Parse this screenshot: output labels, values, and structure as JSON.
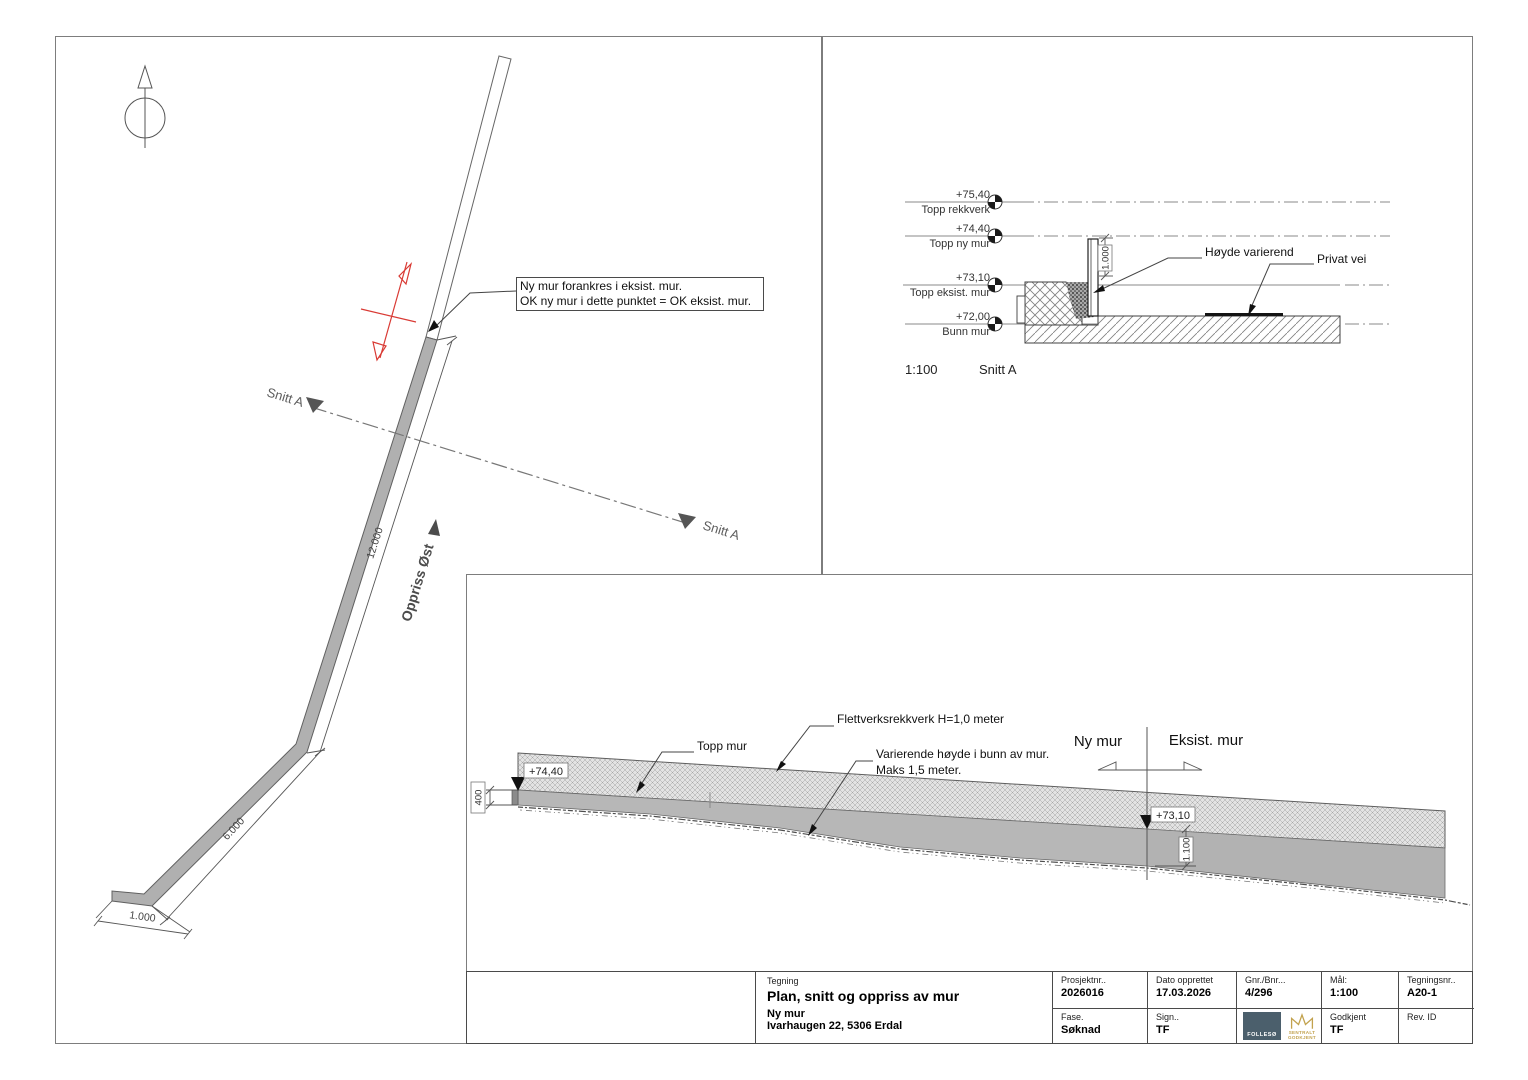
{
  "plan": {
    "annotation_line1": "Ny mur forankres i eksist. mur.",
    "annotation_line2": "OK ny mur i dette punktet = OK eksist. mur.",
    "snitt_label_left": "Snitt A",
    "snitt_label_right": "Snitt A",
    "oppriss_label": "Oppriss Øst",
    "dim_long": "12.000",
    "dim_mid": "6.000",
    "dim_foot": "1.000"
  },
  "section": {
    "scale": "1:100",
    "title": "Snitt A",
    "levels": [
      {
        "value": "+75,40",
        "name": "Topp rekkverk"
      },
      {
        "value": "+74,40",
        "name": "Topp ny mur"
      },
      {
        "value": "+73,10",
        "name": "Topp eksist. mur"
      },
      {
        "value": "+72,00",
        "name": "Bunn mur"
      }
    ],
    "dim_height": "1.000",
    "label_height_varies": "Høyde varierend",
    "label_private_road": "Privat vei"
  },
  "elevation": {
    "label_fence": "Flettverksrekkverk H=1,0 meter",
    "label_wall_top": "Topp mur",
    "label_varying_1": "Varierende høyde i bunn av mur.",
    "label_varying_2": "Maks 1,5 meter.",
    "label_new_wall": "Ny mur",
    "label_existing_wall": "Eksist. mur",
    "level_left": "+74,40",
    "level_mid": "+73,10",
    "dim_400": "400",
    "dim_1100": "1.100"
  },
  "titleblock": {
    "tegning_label": "Tegning",
    "title": "Plan, snitt og oppriss av mur",
    "subtitle": "Ny mur",
    "address": "Ivarhaugen 22,  5306 Erdal",
    "prosjektnr_label": "Prosjektnr..",
    "prosjektnr": "2026016",
    "dato_label": "Dato opprettet",
    "dato": "17.03.2026",
    "gnr_label": "Gnr./Bnr...",
    "gnr": "4/296",
    "maal_label": "Mål:",
    "maal": "1:100",
    "tegningsnr_label": "Tegningsnr..",
    "tegningsnr": "A20-1",
    "fase_label": "Fase.",
    "fase": "Søknad",
    "sign_label": "Sign..",
    "sign": "TF",
    "godkjent_label": "Godkjent",
    "godkjent": "TF",
    "rev_label": "Rev. ID",
    "logo_follesoe": "FOLLESØ",
    "logo_sentralt_line1": "SENTRALT",
    "logo_sentralt_line2": "GODKJENT"
  },
  "colors": {
    "wall_fill": "#b0b0b0",
    "red_marker": "#d93a34",
    "line_dark": "#3f3f3f",
    "logo_follesoe_bg": "#4b5f6c",
    "logo_gold": "#c2a24e"
  }
}
